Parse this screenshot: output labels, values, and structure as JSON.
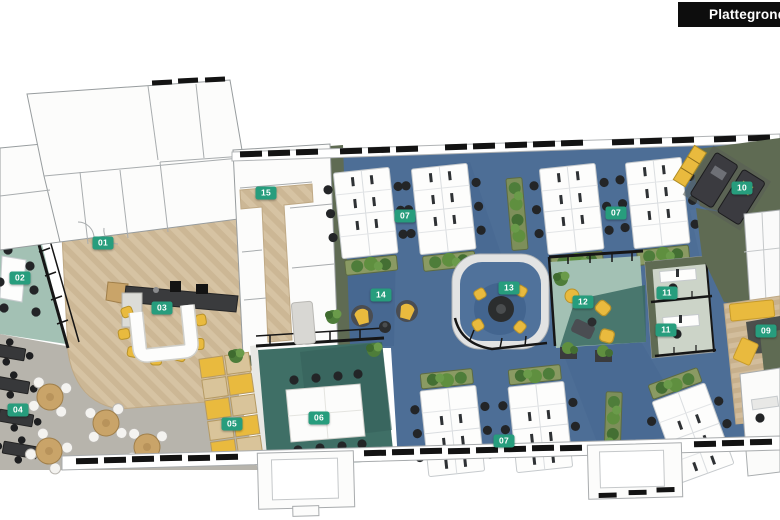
{
  "header": {
    "title": "Plattegrond 6"
  },
  "floorplan": {
    "type": "office-floorplan-axonometric-render",
    "markers": [
      {
        "label": "01",
        "x": 103,
        "y": 243
      },
      {
        "label": "02",
        "x": 20,
        "y": 278
      },
      {
        "label": "03",
        "x": 162,
        "y": 308
      },
      {
        "label": "04",
        "x": 18,
        "y": 410
      },
      {
        "label": "05",
        "x": 232,
        "y": 424
      },
      {
        "label": "06",
        "x": 319,
        "y": 418
      },
      {
        "label": "07",
        "x": 405,
        "y": 216
      },
      {
        "label": "07",
        "x": 616,
        "y": 213
      },
      {
        "label": "07",
        "x": 504,
        "y": 441
      },
      {
        "label": "09",
        "x": 766,
        "y": 331
      },
      {
        "label": "10",
        "x": 742,
        "y": 188
      },
      {
        "label": "11",
        "x": 667,
        "y": 293
      },
      {
        "label": "11",
        "x": 666,
        "y": 330
      },
      {
        "label": "12",
        "x": 583,
        "y": 302
      },
      {
        "label": "13",
        "x": 509,
        "y": 288
      },
      {
        "label": "14",
        "x": 381,
        "y": 295
      },
      {
        "label": "15",
        "x": 266,
        "y": 193
      }
    ],
    "palette": {
      "marker_green": "#279d7d",
      "title_bar_black": "#0d0d0d",
      "carpet_blue": "#4d6e96",
      "wood_floor": "#d6c3a3",
      "cafe_gray": "#b7b4ac",
      "meeting_teal_dark": "#3f6f66",
      "meeting_teal_light": "#a3c1b4",
      "olive_wall": "#5f6b53",
      "accent_yellow": "#e9ba3e",
      "frame_black": "#161616"
    }
  }
}
